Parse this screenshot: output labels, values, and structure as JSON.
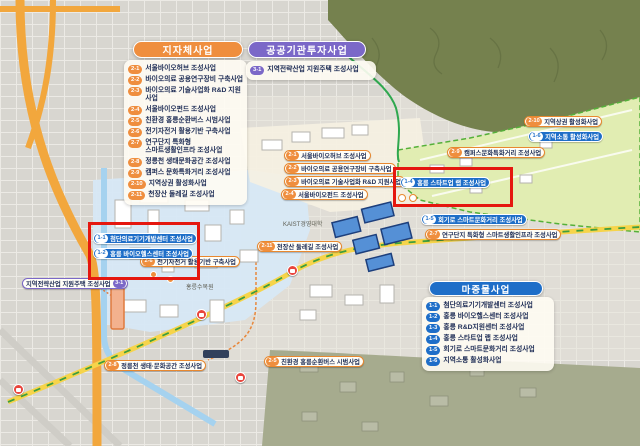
{
  "panels": {
    "local_gov": {
      "title": "지자체사업",
      "accent": "#ef8e3e",
      "items": [
        {
          "num": "2-1",
          "label": "서울바이오허브 조성사업"
        },
        {
          "num": "2-2",
          "label": "바이오의료 공용연구장비 구축사업"
        },
        {
          "num": "2-3",
          "label": "바이오의료 기술사업화 R&D 지원사업"
        },
        {
          "num": "2-4",
          "label": "서울바이오펀드 조성사업"
        },
        {
          "num": "2-5",
          "label": "친환경 홍릉순환버스 시범사업"
        },
        {
          "num": "2-6",
          "label": "전기자전거 활용기반 구축사업"
        },
        {
          "num": "2-7",
          "label": "연구단지 특화형",
          "label2": "스마트생활인프라 조성사업"
        },
        {
          "num": "2-8",
          "label": "정릉천 생태문화공간 조성사업"
        },
        {
          "num": "2-9",
          "label": "캠퍼스 문화특화거리 조성사업"
        },
        {
          "num": "2-10",
          "label": "지역상권 활성화사업"
        },
        {
          "num": "2-11",
          "label": "천장산 둘레길 조성사업"
        }
      ]
    },
    "public_inst": {
      "title": "공공기관투자사업",
      "accent": "#7b68c8",
      "items": [
        {
          "num": "3-1",
          "label": "지역전략산업 지원주택 조성사업"
        }
      ]
    },
    "priming": {
      "title": "마중물사업",
      "accent": "#1e6ec8",
      "items": [
        {
          "num": "1-1",
          "label": "첨단의료기기개발센터 조성사업"
        },
        {
          "num": "1-2",
          "label": "홍릉 바이오헬스센터 조성사업"
        },
        {
          "num": "1-3",
          "label": "홍릉 R&D지원센터 조성사업"
        },
        {
          "num": "1-4",
          "label": "홍릉 스타트업 랩 조성사업"
        },
        {
          "num": "1-5",
          "label": "회기로 스마트문화거리 조성사업"
        },
        {
          "num": "1-6",
          "label": "지역소통 활성화사업"
        }
      ]
    }
  },
  "map": {
    "callouts": [
      {
        "num": "2-1",
        "label": "서울바이오허브 조성사업",
        "style": "orange"
      },
      {
        "num": "2-2",
        "label": "바이오의료 공용연구장비 구축사업",
        "style": "orange"
      },
      {
        "num": "2-3",
        "label": "바이오의료 기술사업화 R&D 지원사업",
        "style": "orange"
      },
      {
        "num": "2-4",
        "label": "서울바이오펀드 조성사업",
        "style": "orange"
      },
      {
        "num": "2-9",
        "label": "캠퍼스문화특화거리 조성사업",
        "style": "orange"
      },
      {
        "num": "2-10",
        "label": "지역상권 활성화사업",
        "style": "orange"
      },
      {
        "num": "2-11",
        "label": "천장산 둘레길 조성사업",
        "style": "orange"
      },
      {
        "num": "2-6",
        "label": "전기자전거 활용기반 구축사업",
        "style": "orange"
      },
      {
        "num": "2-7",
        "label": "연구단지 특화형 스마트생활인프라 조성사업",
        "style": "orange"
      },
      {
        "num": "2-8",
        "label": "정릉천 생태·문화공간 조성사업",
        "style": "orange"
      },
      {
        "num": "2-5",
        "label": "친환경 홍릉순환버스 시범사업",
        "style": "orange"
      },
      {
        "num": "1-1",
        "label": "첨단의료기기개발센터 조성사업",
        "style": "blue"
      },
      {
        "num": "1-2",
        "label": "홍릉 바이오헬스센터 조성사업",
        "style": "blue"
      },
      {
        "num": "1-4",
        "label": "홍릉 스타트업 랩 조성사업",
        "style": "blue"
      },
      {
        "num": "1-5",
        "label": "회기로 스마트문화거리 조성사업",
        "style": "blue"
      },
      {
        "num": "1-6",
        "label": "지역소통 활성화사업",
        "style": "blue"
      },
      {
        "num": "3-1",
        "label": "지역전략산업 지원주택 조성사업",
        "style": "purple"
      }
    ],
    "place_labels": {
      "arboretum": "홍릉수목원",
      "kaist": "KAIST경영대학"
    },
    "colors": {
      "highlight_red": "#e5170f",
      "route_yellow": "#f6d44a",
      "boundary_green": "#2fa84f",
      "accent_orange": "#ef8e3e",
      "accent_blue": "#1e6ec8",
      "accent_purple": "#7b68c8"
    }
  }
}
